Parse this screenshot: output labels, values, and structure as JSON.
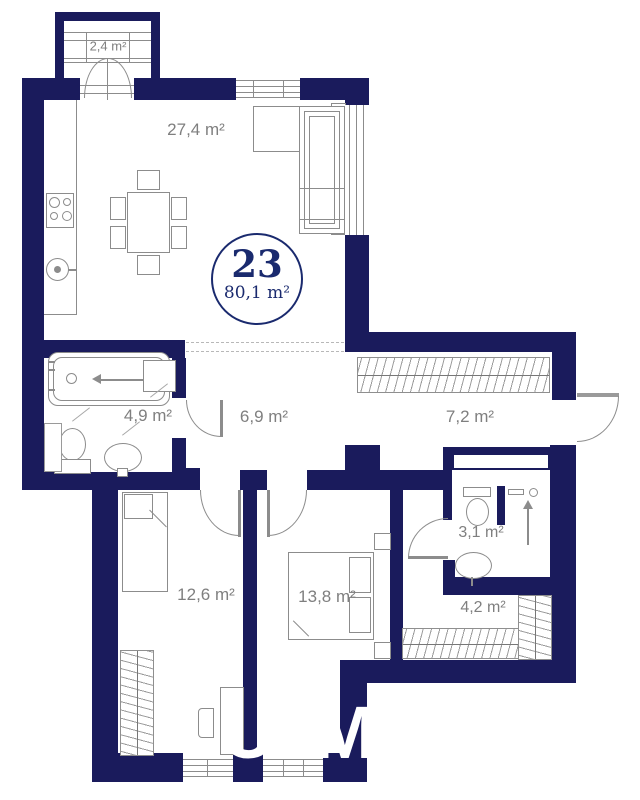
{
  "plan": {
    "badge": {
      "number": "23",
      "area": "80,1 m²"
    },
    "rooms": {
      "balcony": {
        "area": "2,4 m²"
      },
      "living": {
        "area": "27,4 m²"
      },
      "bathroom": {
        "area": "4,9 m²"
      },
      "hallway": {
        "area": "6,9 m²"
      },
      "corridor": {
        "area": "7,2 m²"
      },
      "wc": {
        "area": "3,1 m²"
      },
      "closet": {
        "area": "4,2 m²"
      },
      "bedroom1": {
        "area": "12,6 m²"
      },
      "bedroom2": {
        "area": "13,8 m²"
      }
    },
    "watermark": {
      "letter1": "U",
      "letter2": "M"
    },
    "colors": {
      "wall": "#1a1b5c",
      "line": "#8c8c8c",
      "label": "#7f7f7f",
      "badge_text": "#1a2a6e"
    }
  }
}
